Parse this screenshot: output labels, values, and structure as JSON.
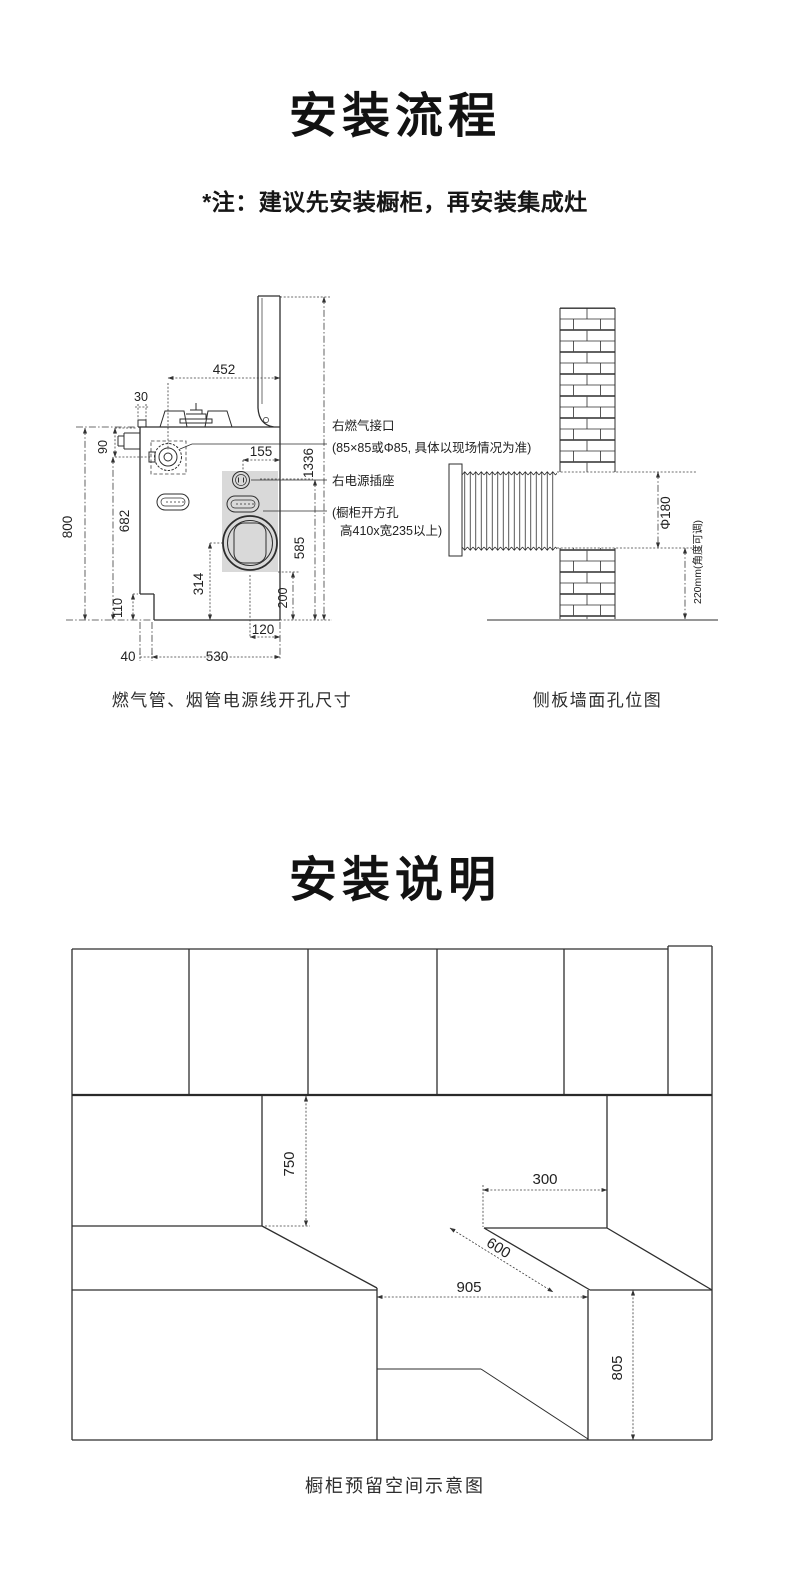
{
  "p1": {
    "title": "安装流程",
    "note": "*注：建议先安装橱柜，再安装集成灶",
    "cutout": {
      "caption": "燃气管、烟管电源线开孔尺寸",
      "labels": {
        "gas": "右燃气接口",
        "gas_note": "(85×85或Φ85, 具体以现场情况为准)",
        "socket": "右电源插座",
        "opening1": "(橱柜开方孔",
        "opening2": "高410x宽235以上)"
      },
      "dims": {
        "top_width": "452",
        "front_lip": "30",
        "gas_inlet_drop": "90",
        "socket_to_edge": "155",
        "overall_height": "1336",
        "body_height": "800",
        "gas_inlet_height": "682",
        "socket_height": "585",
        "flue_center_height": "314",
        "opening_bottom": "200",
        "step_height": "110",
        "flue_to_edge": "120",
        "step_width": "40",
        "bottom_width": "530"
      }
    },
    "wall": {
      "caption": "侧板墙面孔位图",
      "dims": {
        "hole_diameter": "Φ180",
        "hole_height": "220mm(角度可调)"
      }
    }
  },
  "p2": {
    "title": "安装说明",
    "space": {
      "caption": "橱柜预留空间示意图",
      "dims": {
        "clearance_height": "750",
        "top_depth": "300",
        "counter_depth": "600",
        "niche_width": "905",
        "base_height": "805"
      }
    }
  }
}
